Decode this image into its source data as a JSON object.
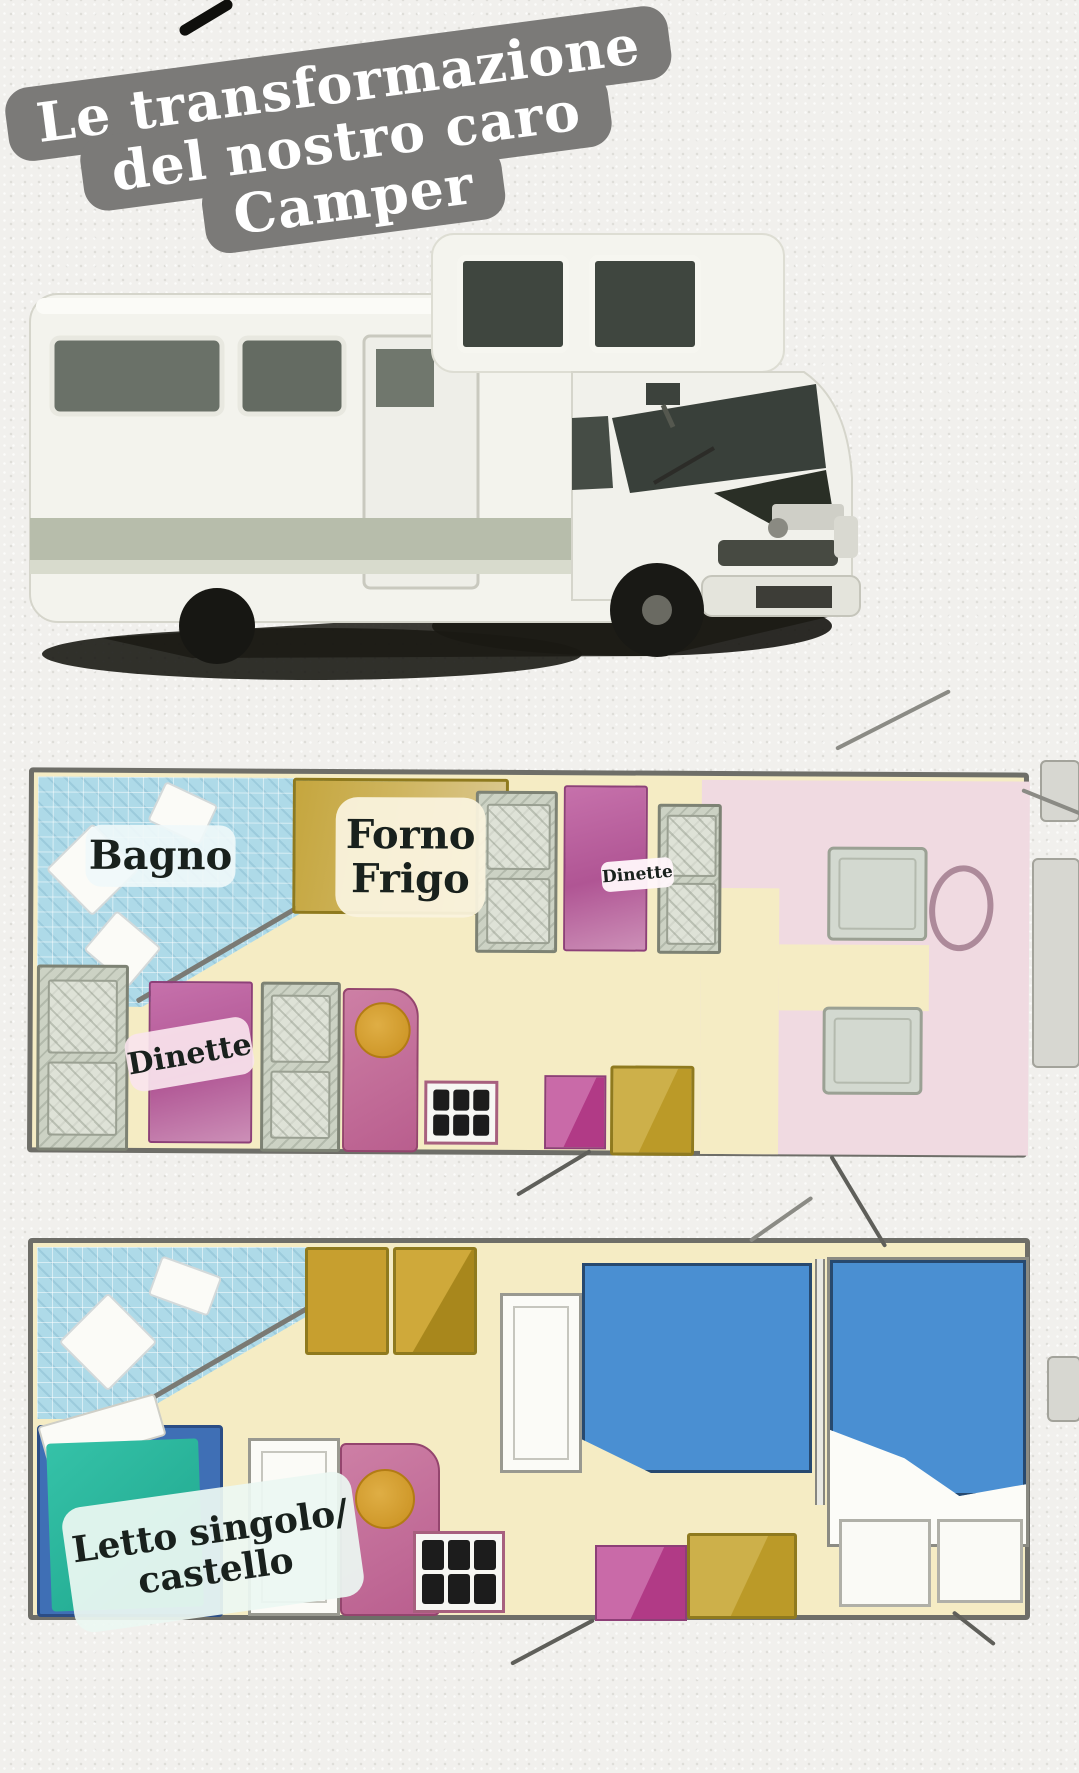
{
  "title": {
    "lines": [
      "Le transformazione",
      "del nostro caro",
      "Camper"
    ],
    "bg_color": "#7b7a78",
    "text_color": "#ffffff"
  },
  "camper_photo": {
    "alt": "white overcab motorhome, three-quarter front view"
  },
  "floorplans": {
    "day": {
      "name": "camper-floorplan-day",
      "labels": {
        "bagno": "Bagno",
        "forno_frigo": [
          "Forno",
          "Frigo"
        ],
        "dinette_front": "Dinette",
        "dinette_rear": "Dinette"
      }
    },
    "night": {
      "name": "camper-floorplan-night",
      "labels": {
        "letto": [
          "Letto singolo/",
          "castello"
        ]
      }
    }
  },
  "colors": {
    "title_card_bg": "#7b7a78",
    "plan_floor": "#f5ecc4",
    "plan_border": "#6e6e68",
    "bath_tile_blue": "#aedae8",
    "wardrobe_gold": "#c2a33c",
    "table_magenta": "#b95f9e",
    "bench_gray": "#ccd2c4",
    "cab_pink": "#f0dae1",
    "bed_blue": "#4a8fd2",
    "bed_teal": "#2bb79d",
    "bed_frame_blue": "#3f6fb5",
    "sink_pink": "#c66a93",
    "sink_bowl_orange": "#d69a33",
    "stove_burner_black": "#1c1c1c",
    "cushion_yellow": "#c6a52e",
    "label_text": "#19211d"
  }
}
